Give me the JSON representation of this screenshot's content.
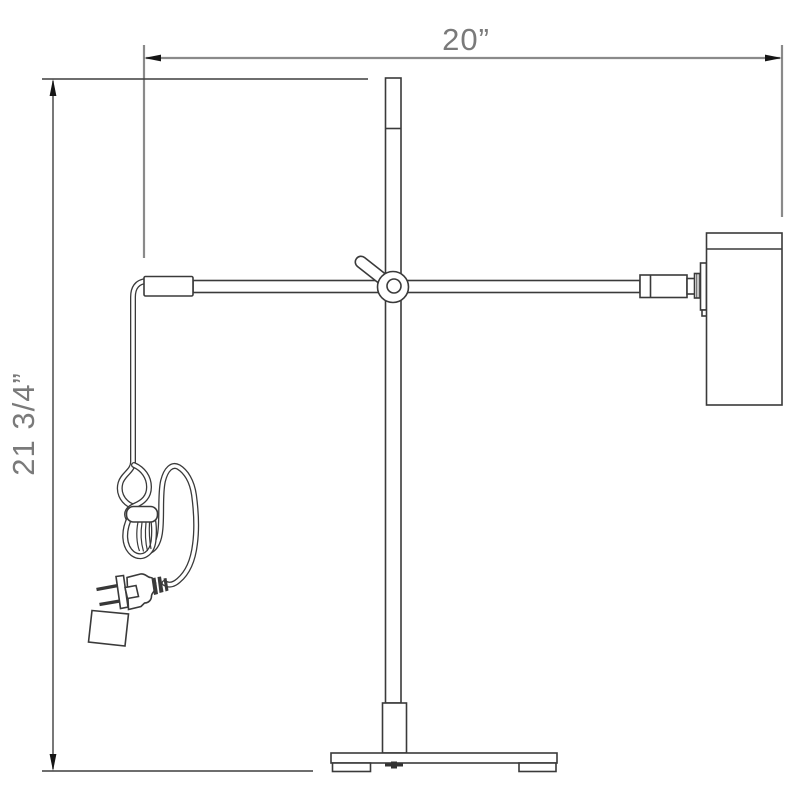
{
  "dimensions": {
    "width_label": "20”",
    "height_label": "21 3/4”"
  },
  "colors": {
    "background": "#ffffff",
    "drawing_line": "#3a3a3a",
    "dimension_line_gray": "#8a8a8a",
    "dimension_line_dark": "#3f3f3f",
    "arrowhead": "#151515",
    "label_text": "#7a7a7a"
  }
}
